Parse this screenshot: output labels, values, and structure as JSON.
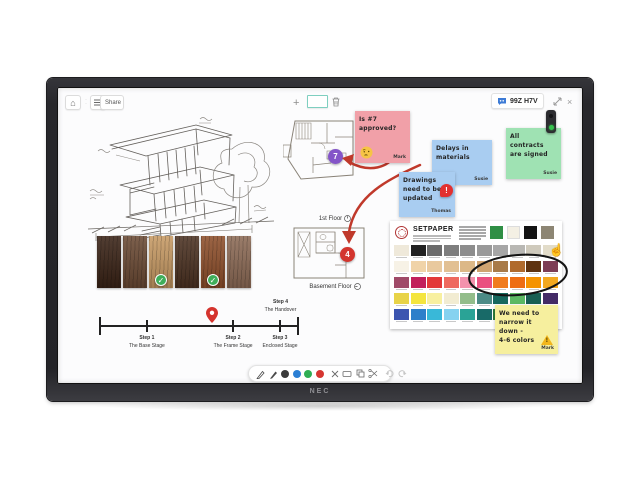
{
  "window": {
    "badge": "99Z H7V",
    "share": "Share",
    "brand": "NEC"
  },
  "notes": {
    "pink": {
      "text": "Is #7\napproved?",
      "author": "Mark"
    },
    "blue1": {
      "text": "Delays in\nmaterials",
      "author": "Susie"
    },
    "blue2": {
      "text": "Drawings\nneed to be\nupdated",
      "author": "Thomas"
    },
    "green": {
      "text": "All\ncontracts\nare signed",
      "author": "Susie"
    },
    "yellow": {
      "text": "We need to\nnarrow it\ndown -\n4-6 colors",
      "author": "Mark"
    }
  },
  "plans": {
    "first": {
      "label": "1st Floor",
      "marker": "7"
    },
    "basement": {
      "label": "Basement Floor",
      "marker": "4"
    }
  },
  "timeline": {
    "pin_pos": 56.6,
    "steps": [
      {
        "label": "Step 1",
        "sub": "The Base Stage",
        "pos": 23.7,
        "above": false
      },
      {
        "label": "Step 2",
        "sub": "The Frame Stage",
        "pos": 67.2,
        "above": false
      },
      {
        "label": "Step 3",
        "sub": "Enclosed Stage",
        "pos": 90.9,
        "above": false
      },
      {
        "label": "Step 4",
        "sub": "The Handover",
        "pos": 100,
        "above": true
      }
    ]
  },
  "wood": {
    "items": [
      {
        "color": "#3a2316",
        "approved": false
      },
      {
        "color": "#6b4a34",
        "approved": false
      },
      {
        "color": "#c79a64",
        "approved": true
      },
      {
        "color": "#4c3222",
        "approved": false
      },
      {
        "color": "#8e4f2b",
        "approved": true
      },
      {
        "color": "#8d6b56",
        "approved": false
      }
    ]
  },
  "setpaper": {
    "title": "SETPAPER",
    "header_swatches": [
      "#2f8f45",
      "#f4f0e4",
      "#141414",
      "#8d8674"
    ],
    "rows": [
      [
        "#efe9da",
        "#222222",
        "#6b6b6b",
        "#7e7e7e",
        "#8d8d8d",
        "#999999",
        "#a7a7a7",
        "#b9b8b4",
        "#cfcabc",
        "#e2dcc9"
      ],
      [
        "#f7f2e6",
        "#f0d3a8",
        "#e9c99e",
        "#e2c093",
        "#dcb887",
        "#cfa471",
        "#a87a48",
        "#b06a2c",
        "#5f3310",
        "#7d3d55"
      ],
      [
        "#a04a68",
        "#c21f5b",
        "#e33838",
        "#ee6a5f",
        "#f392ad",
        "#ea4f80",
        "#f07c1f",
        "#ee6d12",
        "#f59300",
        "#f3a81f"
      ],
      [
        "#e8d348",
        "#f4e53e",
        "#f8f0a0",
        "#f2ecd2",
        "#93bd8b",
        "#4c8b86",
        "#17695e",
        "#5cb963",
        "#195f53",
        "#432a66"
      ],
      [
        "#3c55b0",
        "#2e7fca",
        "#39b8d8",
        "#86d2f0",
        "#2aa396",
        "#186a68",
        "#2c7d3a",
        "#14483a",
        "#5e35a8",
        "#6a2a8a"
      ]
    ]
  },
  "toolbar_bottom": {
    "pen_colors": [
      "#3a3a3a",
      "#2b7fd4",
      "#2fae54",
      "#d63631"
    ]
  }
}
